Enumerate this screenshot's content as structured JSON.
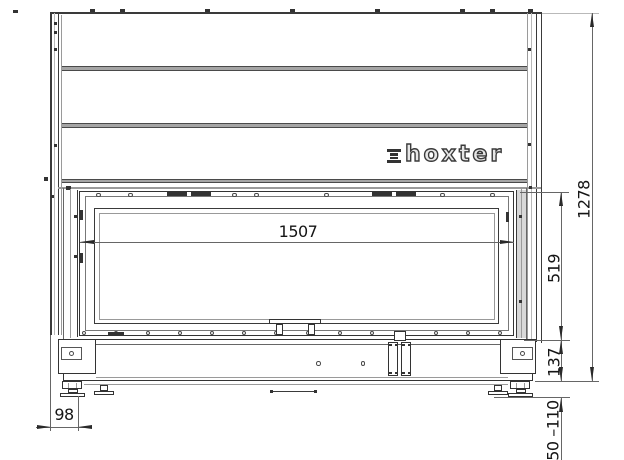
{
  "brand": {
    "name": "hoxter"
  },
  "dimensions": {
    "opening_width": "1507",
    "opening_height": "519",
    "total_height": "1278",
    "base_height": "137",
    "foot_height_range": "50 –110",
    "side_depth": "98"
  },
  "colors": {
    "line": "#3a3a3a",
    "dim_line": "#666666",
    "band_fill": "#a5a5a5",
    "background": "#ffffff"
  }
}
